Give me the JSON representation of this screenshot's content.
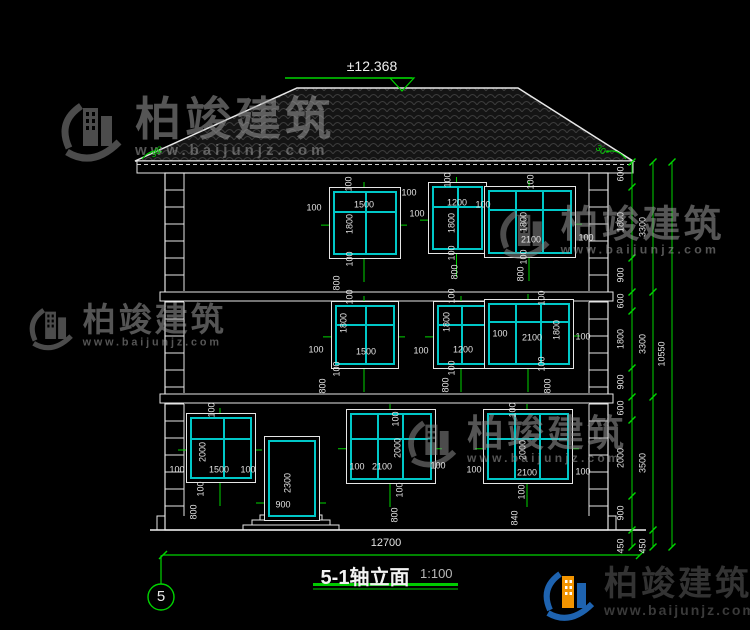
{
  "header": {
    "elevation_mark": "±12.368"
  },
  "titleblock": {
    "title": "5-1轴立面",
    "scale": "1:100",
    "axis_label": "5"
  },
  "watermark": {
    "brand": "柏竣建筑",
    "url": "www.baijunjz.com"
  },
  "bottom_dim": {
    "label": "12700",
    "y": 555,
    "x1": 163,
    "x2": 640
  },
  "roof_angles": [
    {
      "t": "30°",
      "x": 157,
      "y": 152,
      "r": -35
    },
    {
      "t": "30°",
      "x": 602,
      "y": 151,
      "r": 35
    }
  ],
  "openings": [
    {
      "name": "window-3f-1500",
      "x": 333,
      "y": 191,
      "w": 62,
      "h": 62,
      "v": [
        0.52
      ],
      "hz": [
        0.32
      ],
      "door": false
    },
    {
      "name": "window-3f-1200",
      "x": 432,
      "y": 186,
      "w": 49,
      "h": 62,
      "v": [
        0.5
      ],
      "hz": [
        0.32
      ],
      "door": false
    },
    {
      "name": "window-3f-2100",
      "x": 488,
      "y": 190,
      "w": 82,
      "h": 62,
      "v": [
        0.33,
        0.66
      ],
      "hz": [
        0.3
      ],
      "door": false
    },
    {
      "name": "window-2f-1500",
      "x": 335,
      "y": 305,
      "w": 58,
      "h": 58,
      "v": [
        0.52
      ],
      "hz": [
        0.32
      ],
      "door": false
    },
    {
      "name": "window-2f-1200",
      "x": 437,
      "y": 305,
      "w": 48,
      "h": 58,
      "v": [
        0.5
      ],
      "hz": [
        0.32
      ],
      "door": false
    },
    {
      "name": "window-2f-2100",
      "x": 488,
      "y": 303,
      "w": 80,
      "h": 60,
      "v": [
        0.33,
        0.66
      ],
      "hz": [
        0.3
      ],
      "door": false
    },
    {
      "name": "window-1f-1500",
      "x": 190,
      "y": 417,
      "w": 60,
      "h": 60,
      "v": [
        0.55
      ],
      "hz": [
        0.35
      ],
      "door": false
    },
    {
      "name": "entry-door",
      "x": 268,
      "y": 440,
      "w": 46,
      "h": 75,
      "v": [],
      "hz": [],
      "door": true
    },
    {
      "name": "window-1f-2100-left",
      "x": 350,
      "y": 413,
      "w": 80,
      "h": 65,
      "v": [
        0.33,
        0.66
      ],
      "hz": [
        0.38
      ],
      "door": false
    },
    {
      "name": "window-1f-2100-right",
      "x": 487,
      "y": 413,
      "w": 80,
      "h": 65,
      "v": [
        0.33,
        0.66
      ],
      "hz": [
        0.38
      ],
      "door": false
    }
  ],
  "labels": [
    {
      "t": "100",
      "x": 349,
      "y": 184,
      "r": -90
    },
    {
      "t": "1500",
      "x": 364,
      "y": 205,
      "r": 0
    },
    {
      "t": "100",
      "x": 409,
      "y": 193,
      "r": 0
    },
    {
      "t": "100",
      "x": 314,
      "y": 208,
      "r": 0
    },
    {
      "t": "1800",
      "x": 350,
      "y": 224,
      "r": -90
    },
    {
      "t": "100",
      "x": 350,
      "y": 259,
      "r": -90
    },
    {
      "t": "800",
      "x": 337,
      "y": 283,
      "r": -90
    },
    {
      "t": "100",
      "x": 448,
      "y": 180,
      "r": -90
    },
    {
      "t": "1200",
      "x": 457,
      "y": 203,
      "r": 0
    },
    {
      "t": "100",
      "x": 417,
      "y": 214,
      "r": 0
    },
    {
      "t": "1800",
      "x": 452,
      "y": 223,
      "r": -90
    },
    {
      "t": "100",
      "x": 452,
      "y": 253,
      "r": -90
    },
    {
      "t": "800",
      "x": 455,
      "y": 272,
      "r": -90
    },
    {
      "t": "100",
      "x": 531,
      "y": 182,
      "r": -90
    },
    {
      "t": "100",
      "x": 483,
      "y": 205,
      "r": 0
    },
    {
      "t": "1800",
      "x": 524,
      "y": 222,
      "r": -90
    },
    {
      "t": "2100",
      "x": 531,
      "y": 240,
      "r": 0
    },
    {
      "t": "100",
      "x": 586,
      "y": 238,
      "r": 0
    },
    {
      "t": "100",
      "x": 524,
      "y": 257,
      "r": -90
    },
    {
      "t": "800",
      "x": 521,
      "y": 274,
      "r": -90
    },
    {
      "t": "100",
      "x": 350,
      "y": 297,
      "r": -90
    },
    {
      "t": "1800",
      "x": 344,
      "y": 323,
      "r": -90
    },
    {
      "t": "1500",
      "x": 366,
      "y": 352,
      "r": 0
    },
    {
      "t": "100",
      "x": 316,
      "y": 350,
      "r": 0
    },
    {
      "t": "100",
      "x": 337,
      "y": 369,
      "r": -90
    },
    {
      "t": "800",
      "x": 323,
      "y": 386,
      "r": -90
    },
    {
      "t": "100",
      "x": 452,
      "y": 296,
      "r": -90
    },
    {
      "t": "1800",
      "x": 447,
      "y": 322,
      "r": -90
    },
    {
      "t": "1200",
      "x": 463,
      "y": 350,
      "r": 0
    },
    {
      "t": "100",
      "x": 421,
      "y": 351,
      "r": 0
    },
    {
      "t": "100",
      "x": 452,
      "y": 368,
      "r": -90
    },
    {
      "t": "800",
      "x": 446,
      "y": 385,
      "r": -90
    },
    {
      "t": "100",
      "x": 542,
      "y": 298,
      "r": -90
    },
    {
      "t": "1800",
      "x": 557,
      "y": 330,
      "r": -90
    },
    {
      "t": "100",
      "x": 500,
      "y": 334,
      "r": 0
    },
    {
      "t": "2100",
      "x": 532,
      "y": 338,
      "r": 0
    },
    {
      "t": "100",
      "x": 583,
      "y": 337,
      "r": 0
    },
    {
      "t": "100",
      "x": 542,
      "y": 364,
      "r": -90
    },
    {
      "t": "800",
      "x": 548,
      "y": 386,
      "r": -90
    },
    {
      "t": "100",
      "x": 212,
      "y": 410,
      "r": -90
    },
    {
      "t": "2000",
      "x": 203,
      "y": 452,
      "r": -90
    },
    {
      "t": "1500",
      "x": 219,
      "y": 470,
      "r": 0
    },
    {
      "t": "100",
      "x": 177,
      "y": 470,
      "r": 0
    },
    {
      "t": "100",
      "x": 248,
      "y": 470,
      "r": 0
    },
    {
      "t": "100",
      "x": 201,
      "y": 489,
      "r": -90
    },
    {
      "t": "800",
      "x": 194,
      "y": 512,
      "r": -90
    },
    {
      "t": "2300",
      "x": 288,
      "y": 483,
      "r": -90
    },
    {
      "t": "900",
      "x": 283,
      "y": 505,
      "r": 0
    },
    {
      "t": "100",
      "x": 396,
      "y": 419,
      "r": -90
    },
    {
      "t": "2000",
      "x": 398,
      "y": 448,
      "r": -90
    },
    {
      "t": "2100",
      "x": 382,
      "y": 467,
      "r": 0
    },
    {
      "t": "100",
      "x": 357,
      "y": 467,
      "r": 0
    },
    {
      "t": "100",
      "x": 438,
      "y": 466,
      "r": 0
    },
    {
      "t": "100",
      "x": 400,
      "y": 490,
      "r": -90
    },
    {
      "t": "800",
      "x": 395,
      "y": 515,
      "r": -90
    },
    {
      "t": "100",
      "x": 513,
      "y": 410,
      "r": -90
    },
    {
      "t": "2000",
      "x": 523,
      "y": 450,
      "r": -90
    },
    {
      "t": "2100",
      "x": 527,
      "y": 473,
      "r": 0
    },
    {
      "t": "100",
      "x": 474,
      "y": 470,
      "r": 0
    },
    {
      "t": "100",
      "x": 583,
      "y": 472,
      "r": 0
    },
    {
      "t": "100",
      "x": 522,
      "y": 492,
      "r": -90
    },
    {
      "t": "840",
      "x": 515,
      "y": 518,
      "r": -90
    }
  ],
  "dim_chains": [
    {
      "x": 632,
      "lx": 621,
      "ticks": [
        162,
        187,
        258,
        292,
        311,
        368,
        397,
        420,
        496,
        530,
        547
      ],
      "labels": [
        {
          "t": "600",
          "y": 174
        },
        {
          "t": "1800",
          "y": 222
        },
        {
          "t": "900",
          "y": 275
        },
        {
          "t": "600",
          "y": 301
        },
        {
          "t": "1800",
          "y": 339
        },
        {
          "t": "900",
          "y": 382
        },
        {
          "t": "600",
          "y": 408
        },
        {
          "t": "2000",
          "y": 458
        },
        {
          "t": "900",
          "y": 513
        },
        {
          "t": "450",
          "y": 546
        }
      ]
    },
    {
      "x": 653,
      "lx": 643,
      "ticks": [
        162,
        292,
        397,
        530,
        547
      ],
      "labels": [
        {
          "t": "3300",
          "y": 227
        },
        {
          "t": "3300",
          "y": 344
        },
        {
          "t": "3500",
          "y": 463
        },
        {
          "t": "450",
          "y": 546
        }
      ]
    },
    {
      "x": 672,
      "lx": 662,
      "ticks": [
        162,
        547
      ],
      "labels": [
        {
          "t": "10550",
          "y": 354
        }
      ]
    }
  ],
  "watermarks_layout": [
    {
      "x": 55,
      "y": 96,
      "s": 1.0
    },
    {
      "x": 495,
      "y": 205,
      "s": 0.82
    },
    {
      "x": 25,
      "y": 303,
      "s": 0.72
    },
    {
      "x": 403,
      "y": 415,
      "s": 0.8
    }
  ]
}
